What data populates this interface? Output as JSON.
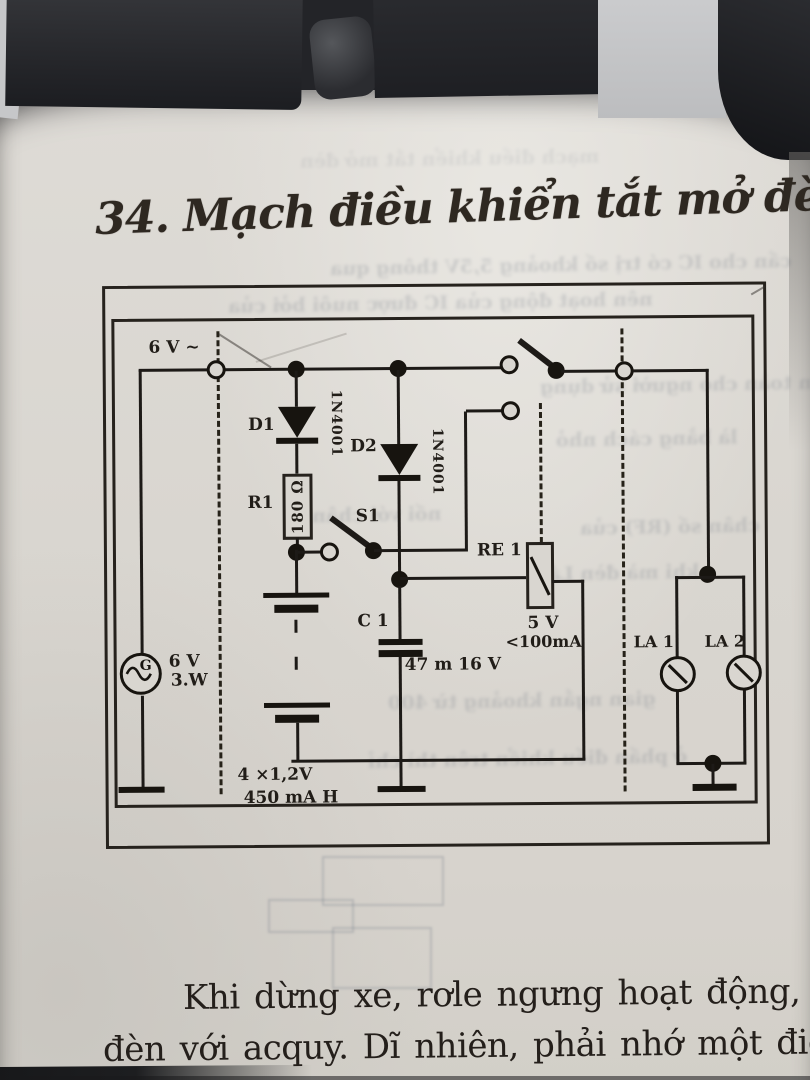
{
  "title": "34. Mạch điều khiển tắt mở đèn tự",
  "paragraph": {
    "line1": "Khi dừng xe, rơle ngưng hoạt động, tiế",
    "line2": "đèn với acquy. Dĩ nhiên, phải nhớ một điều"
  },
  "circuit": {
    "ac_input_label": "6 V ~",
    "generator": {
      "symbol": "G",
      "volts": "6 V",
      "watts": "3.W"
    },
    "d1": {
      "ref": "D1",
      "part": "1N4001"
    },
    "d2": {
      "ref": "D2",
      "part": "1N4001"
    },
    "r1": {
      "ref": "R1",
      "value": "180 Ω"
    },
    "s1": {
      "ref": "S1"
    },
    "c1": {
      "ref": "C 1",
      "value": "47 m 16 V"
    },
    "re1": {
      "ref": "RE 1",
      "volts": "5 V",
      "current": "<100mA"
    },
    "battery": {
      "cells": "4 ×1,2V",
      "capacity": "450 mA H"
    },
    "la1": {
      "ref": "LA 1"
    },
    "la2": {
      "ref": "LA 2"
    }
  },
  "bleed": {
    "l0": "mạch điều khiển tắt mở đèn",
    "l1": "cần cho IC có trị số khoảng 5,5V thông qua",
    "l2": "nên hoạt động của IC được nuôi bởi của",
    "l3": "an toàn cho người sử dụng",
    "l4": "là bằng cách nhỏ",
    "l5": "nối với chân",
    "l6": "chân số (RF) của",
    "l7": "khi mà đèn Lá",
    "l8": "gian ngắn khoảng từ 400",
    "l9": "ở phần điều khiển trên thì chỉ"
  },
  "colors": {
    "ink": "#1d1a17",
    "paper": "#d9d6d0"
  }
}
